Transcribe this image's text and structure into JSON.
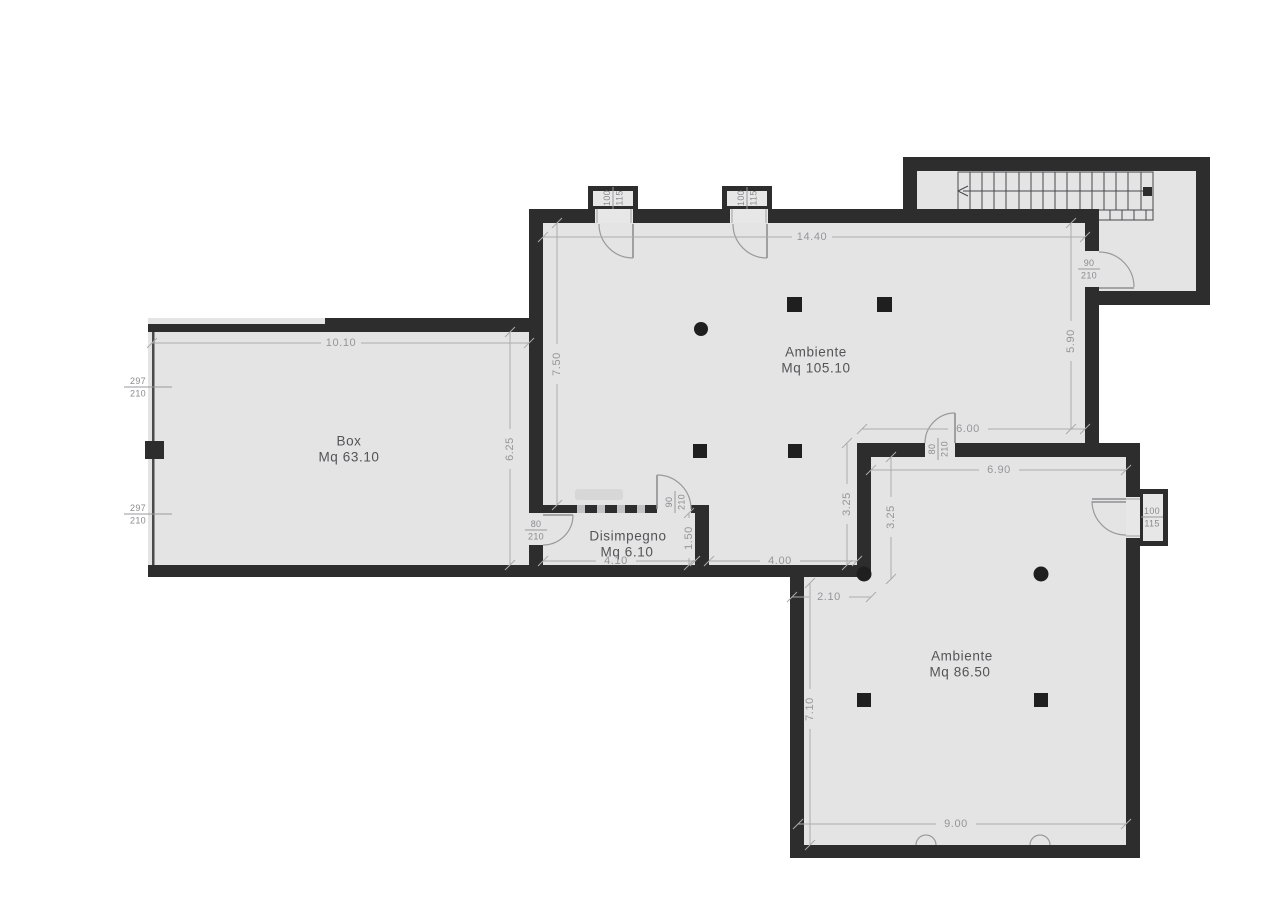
{
  "colors": {
    "wall": "#2d2d2e",
    "room_fill": "#e4e4e5",
    "dim_text": "#96969a",
    "label_text": "#545457",
    "arc_stroke": "#9a9a9c"
  },
  "rooms": {
    "main": {
      "name": "Ambiente",
      "area": "Mq 105.10"
    },
    "box": {
      "name": "Box",
      "area": "Mq 63.10"
    },
    "disimpegno": {
      "name": "Disimpegno",
      "area": "Mq 6.10"
    },
    "lower": {
      "name": "Ambiente",
      "area": "Mq 86.50"
    }
  },
  "dimensions": {
    "main_top": "14.40",
    "main_left": "7.50",
    "main_right": "5.90",
    "box_top": "10.10",
    "box_right": "6.25",
    "upper_right": "6.00",
    "lower_top": "6.90",
    "mid_left": "3.25",
    "mid_right": "3.25",
    "lobe": "4.00",
    "disimpegno_w": "4.10",
    "disimpegno_h": "1.50",
    "notch": "2.10",
    "lower_left": "7.10",
    "lower_bottom": "9.00"
  },
  "openings": {
    "win_top_1": {
      "w": "100",
      "h": "115"
    },
    "win_top_2": {
      "w": "100",
      "h": "115"
    },
    "garage_1": {
      "w": "297",
      "h": "210"
    },
    "garage_2": {
      "w": "297",
      "h": "210"
    },
    "door_stair": {
      "w": "90",
      "h": "210"
    },
    "door_disimpegno": {
      "w": "90",
      "h": "210"
    },
    "door_box": {
      "w": "80",
      "h": "210"
    },
    "door_rooms": {
      "w": "80",
      "h": "210"
    },
    "win_right": {
      "w": "100",
      "h": "115"
    }
  }
}
